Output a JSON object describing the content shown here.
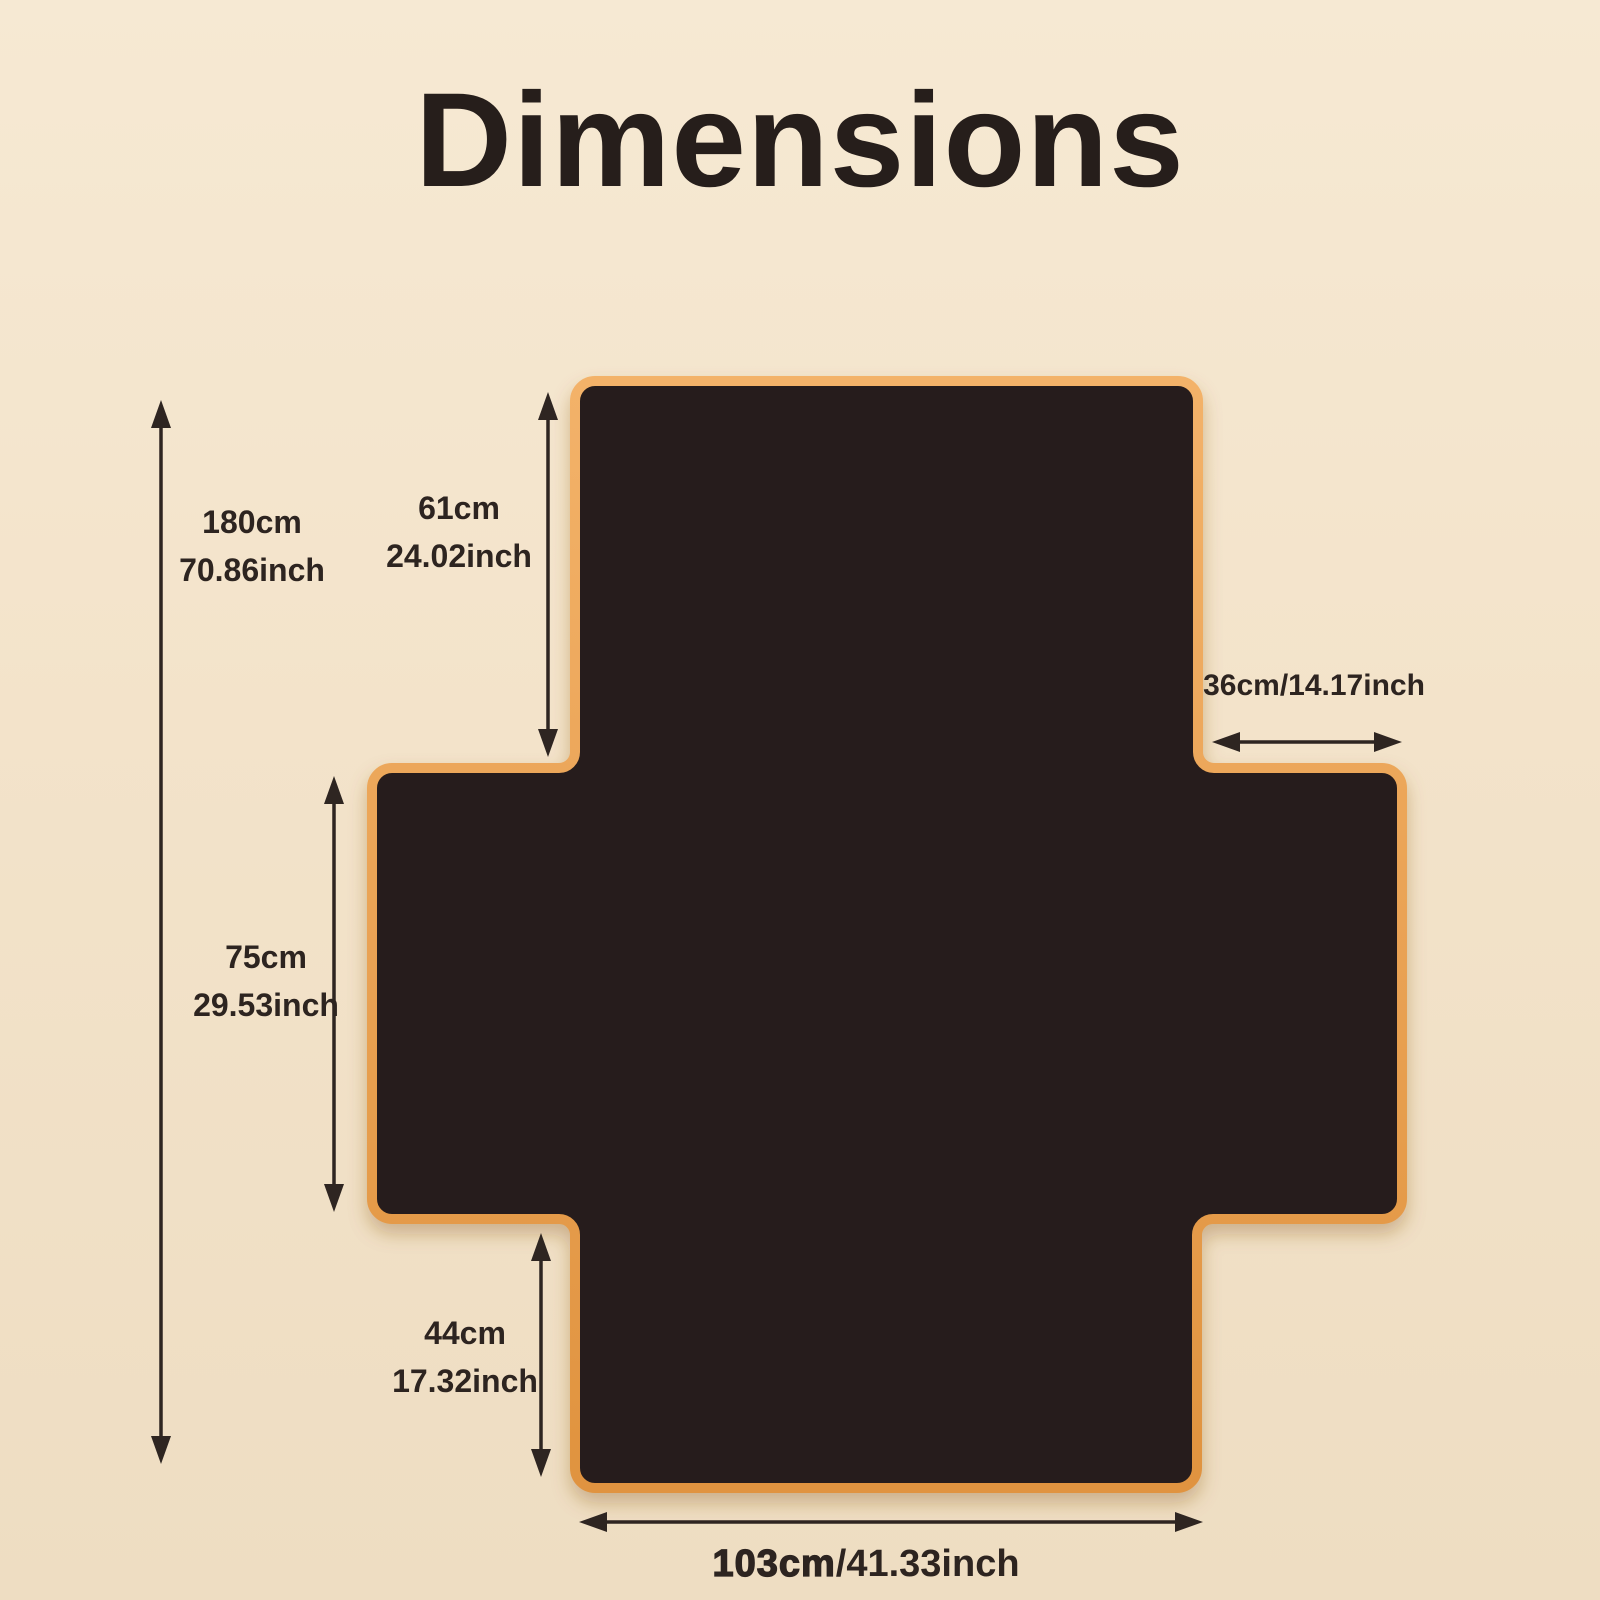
{
  "title": "Dimensions",
  "colors": {
    "background": "#f3e4cc",
    "mat_fill": "#271e1b",
    "mat_border_light": "#f3b269",
    "mat_border_dark": "#e0933f",
    "text": "#2d2420",
    "arrow": "#2e2521"
  },
  "measurements": {
    "total_height": {
      "cm": "180cm",
      "inch": "70.86inch"
    },
    "top_height": {
      "cm": "61cm",
      "inch": "24.02inch"
    },
    "right_arm_width": {
      "text": "36cm/14.17inch"
    },
    "middle_height": {
      "cm": "75cm",
      "inch": "29.53inch"
    },
    "bottom_height": {
      "cm": "44cm",
      "inch": "17.32inch"
    },
    "bottom_width": {
      "cm": "103cm",
      "inch": "/41.33inch"
    }
  }
}
